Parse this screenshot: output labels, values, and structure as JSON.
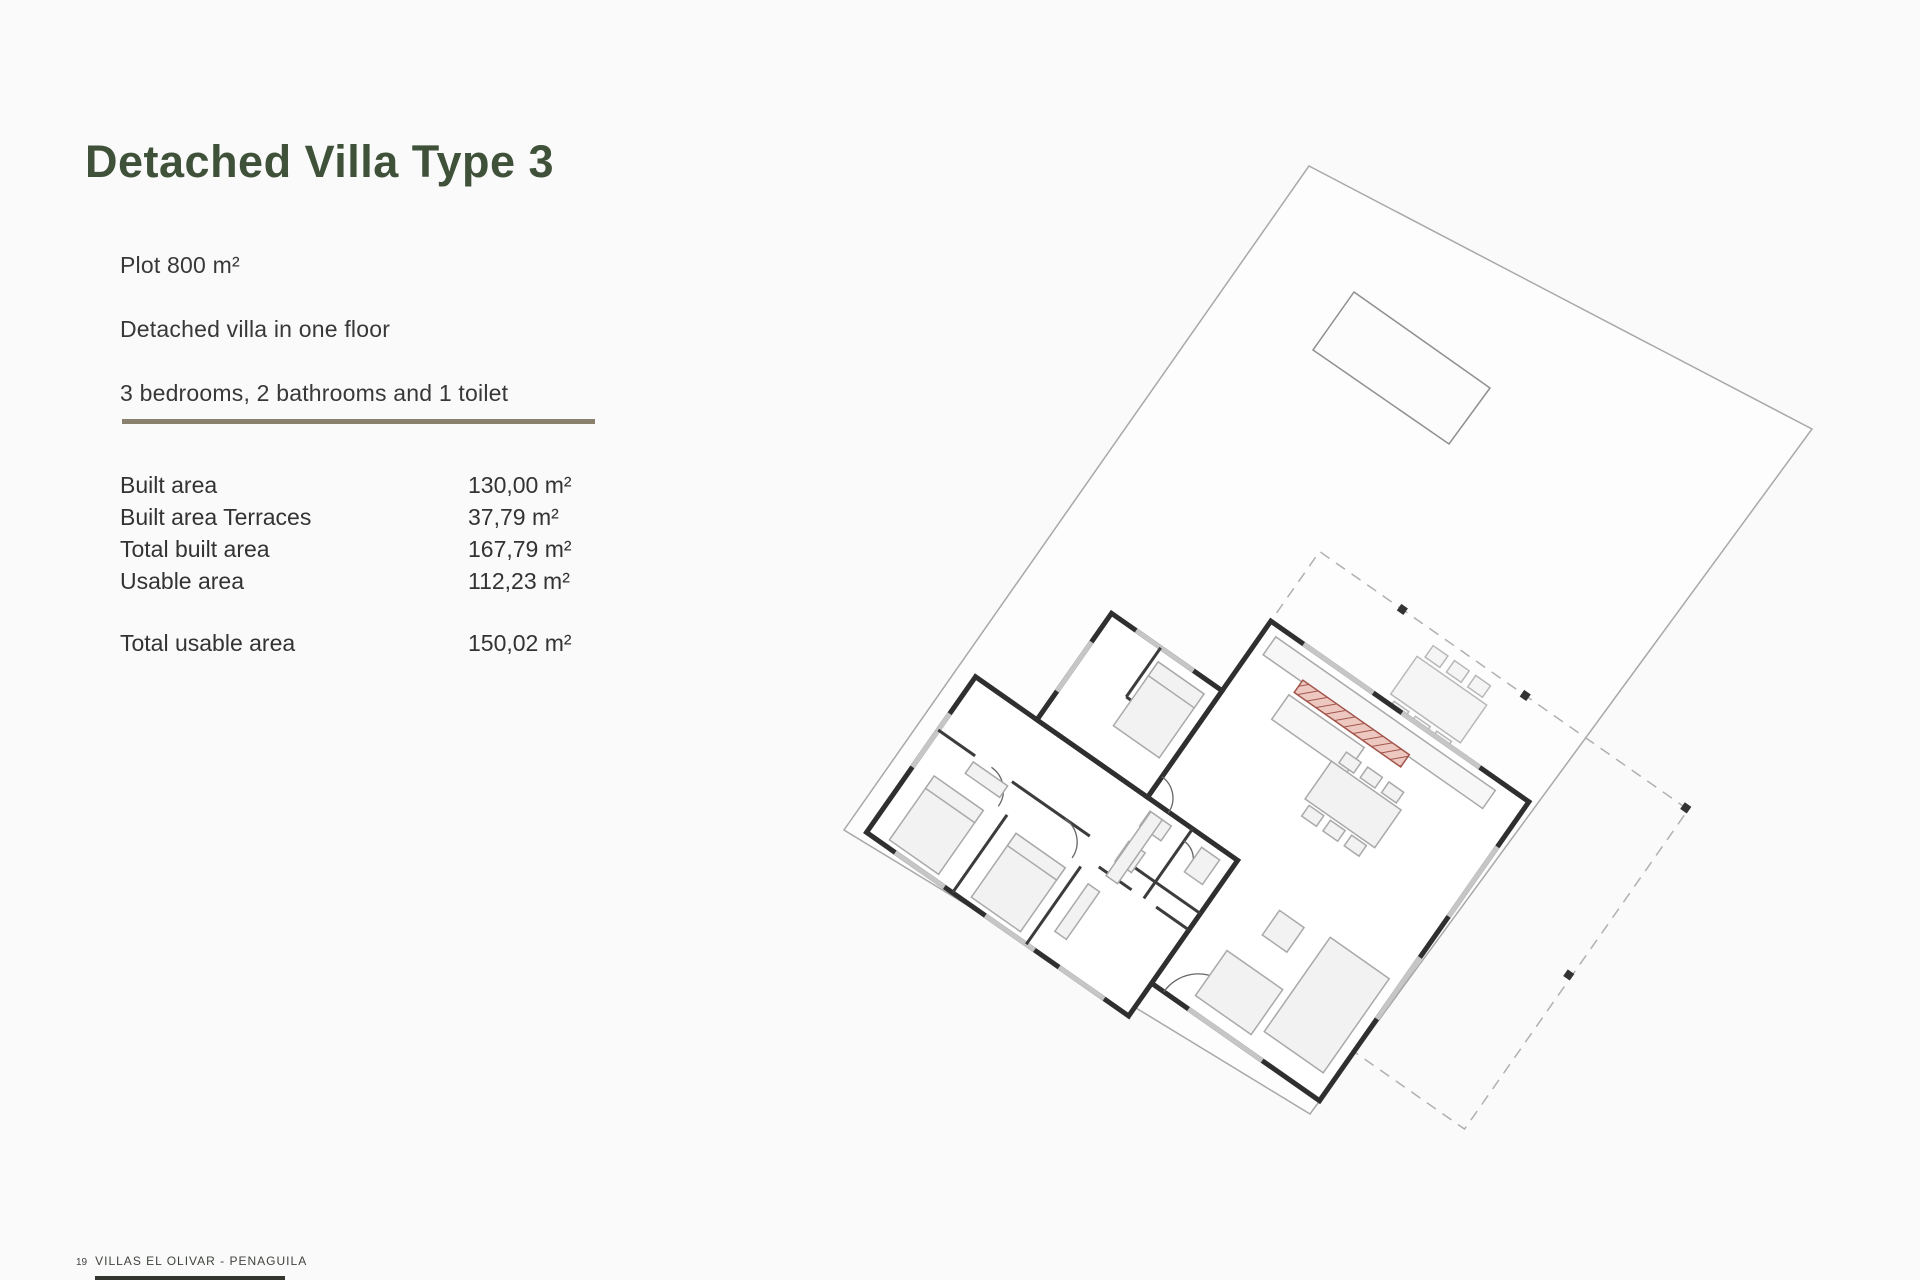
{
  "page": {
    "title": "Detached Villa Type 3",
    "intro": [
      "Plot 800 m²",
      "Detached villa in one floor",
      "3 bedrooms, 2 bathrooms and 1 toilet"
    ]
  },
  "specs": {
    "rows": [
      {
        "label": "Built area",
        "value": "130,00 m²"
      },
      {
        "label": "Built area Terraces",
        "value": "37,79 m²"
      },
      {
        "label": "Total built area",
        "value": "167,79 m²"
      },
      {
        "label": "Usable area",
        "value": "112,23 m²"
      }
    ],
    "total_row": {
      "label": "Total usable area",
      "value": "150,02 m²"
    }
  },
  "footer": {
    "page_number": "19",
    "project": "VILLAS EL OLIVAR - PENAGUILA"
  },
  "colors": {
    "title_green": "#3f5239",
    "divider_olive": "#89816e",
    "wall_dark": "#2f2f2f",
    "accent_red": "#a2544a",
    "plan_line_gray": "#a8a8a8"
  }
}
